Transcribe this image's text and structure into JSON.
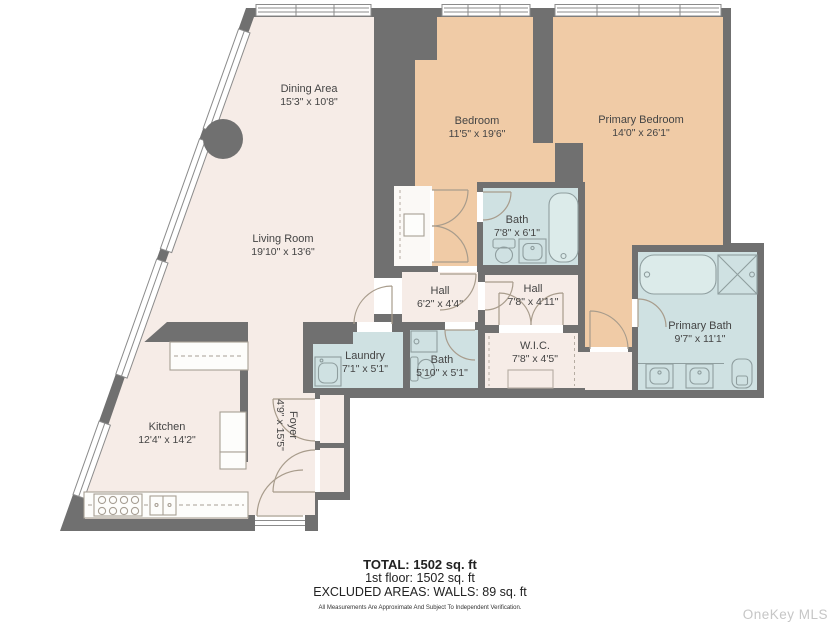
{
  "colors": {
    "wall": "#707070",
    "room": "#f6ece7",
    "bedroom": "#f0cba6",
    "bath": "#cfe1e2",
    "watermark": "#c6c6c6"
  },
  "rooms": [
    {
      "id": "dining-area",
      "name": "Dining Area",
      "dims": "15'3\" x 10'8\"",
      "x": 309,
      "y": 96,
      "rotate": 0
    },
    {
      "id": "living-room",
      "name": "Living Room",
      "dims": "19'10\" x 13'6\"",
      "x": 283,
      "y": 246,
      "rotate": 0
    },
    {
      "id": "bedroom",
      "name": "Bedroom",
      "dims": "11'5\" x 19'6\"",
      "x": 477,
      "y": 128,
      "rotate": 0
    },
    {
      "id": "primary-bedroom",
      "name": "Primary Bedroom",
      "dims": "14'0\" x 26'1\"",
      "x": 641,
      "y": 127,
      "rotate": 0
    },
    {
      "id": "bath-upper",
      "name": "Bath",
      "dims": "7'8\" x 6'1\"",
      "x": 517,
      "y": 227,
      "rotate": 0
    },
    {
      "id": "hall-west",
      "name": "Hall",
      "dims": "6'2\" x 4'4\"",
      "x": 440,
      "y": 298,
      "rotate": 0
    },
    {
      "id": "hall-east",
      "name": "Hall",
      "dims": "7'8\" x 4'11\"",
      "x": 533,
      "y": 296,
      "rotate": 0
    },
    {
      "id": "wic",
      "name": "W.I.C.",
      "dims": "7'8\" x 4'5\"",
      "x": 535,
      "y": 353,
      "rotate": 0
    },
    {
      "id": "primary-bath",
      "name": "Primary Bath",
      "dims": "9'7\" x 11'1\"",
      "x": 700,
      "y": 333,
      "rotate": 0
    },
    {
      "id": "laundry",
      "name": "Laundry",
      "dims": "7'1\" x 5'1\"",
      "x": 365,
      "y": 363,
      "rotate": 0
    },
    {
      "id": "bath-lower",
      "name": "Bath",
      "dims": "5'10\" x 5'1\"",
      "x": 442,
      "y": 367,
      "rotate": 0
    },
    {
      "id": "kitchen",
      "name": "Kitchen",
      "dims": "12'4\" x 14'2\"",
      "x": 167,
      "y": 434,
      "rotate": 0
    },
    {
      "id": "foyer",
      "name": "Foyer",
      "dims": "4'9\" x 15'5\"",
      "x": 286,
      "y": 425,
      "rotate": 90
    }
  ],
  "summary": {
    "total": "TOTAL: 1502 sq. ft",
    "floor": "1st floor: 1502 sq. ft",
    "excluded": "EXCLUDED AREAS: WALLS: 89 sq. ft",
    "disclaimer": "All Measurements Are Approximate And Subject To Independent Verification."
  },
  "watermark": "OneKey MLS"
}
